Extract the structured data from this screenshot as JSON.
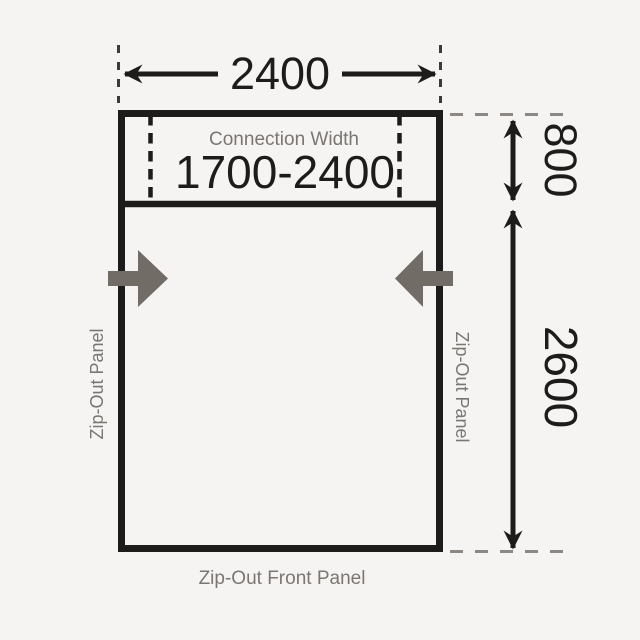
{
  "diagram": {
    "type": "awning-dimension-plan",
    "top_dimension": "2400",
    "connection_section": {
      "label": "Connection Width",
      "value": "1700-2400",
      "depth_dimension": "800"
    },
    "main_section": {
      "depth_dimension": "2600"
    },
    "panel_labels": {
      "left": "Zip-Out Panel",
      "right": "Zip-Out Panel",
      "front": "Zip-Out Front Panel"
    },
    "colors": {
      "background": "#f5f4f2",
      "line_black": "#1d1c1a",
      "label_gray": "#7b7672",
      "arrow_gray": "#726c67",
      "dash_gray": "#8d8883"
    }
  }
}
